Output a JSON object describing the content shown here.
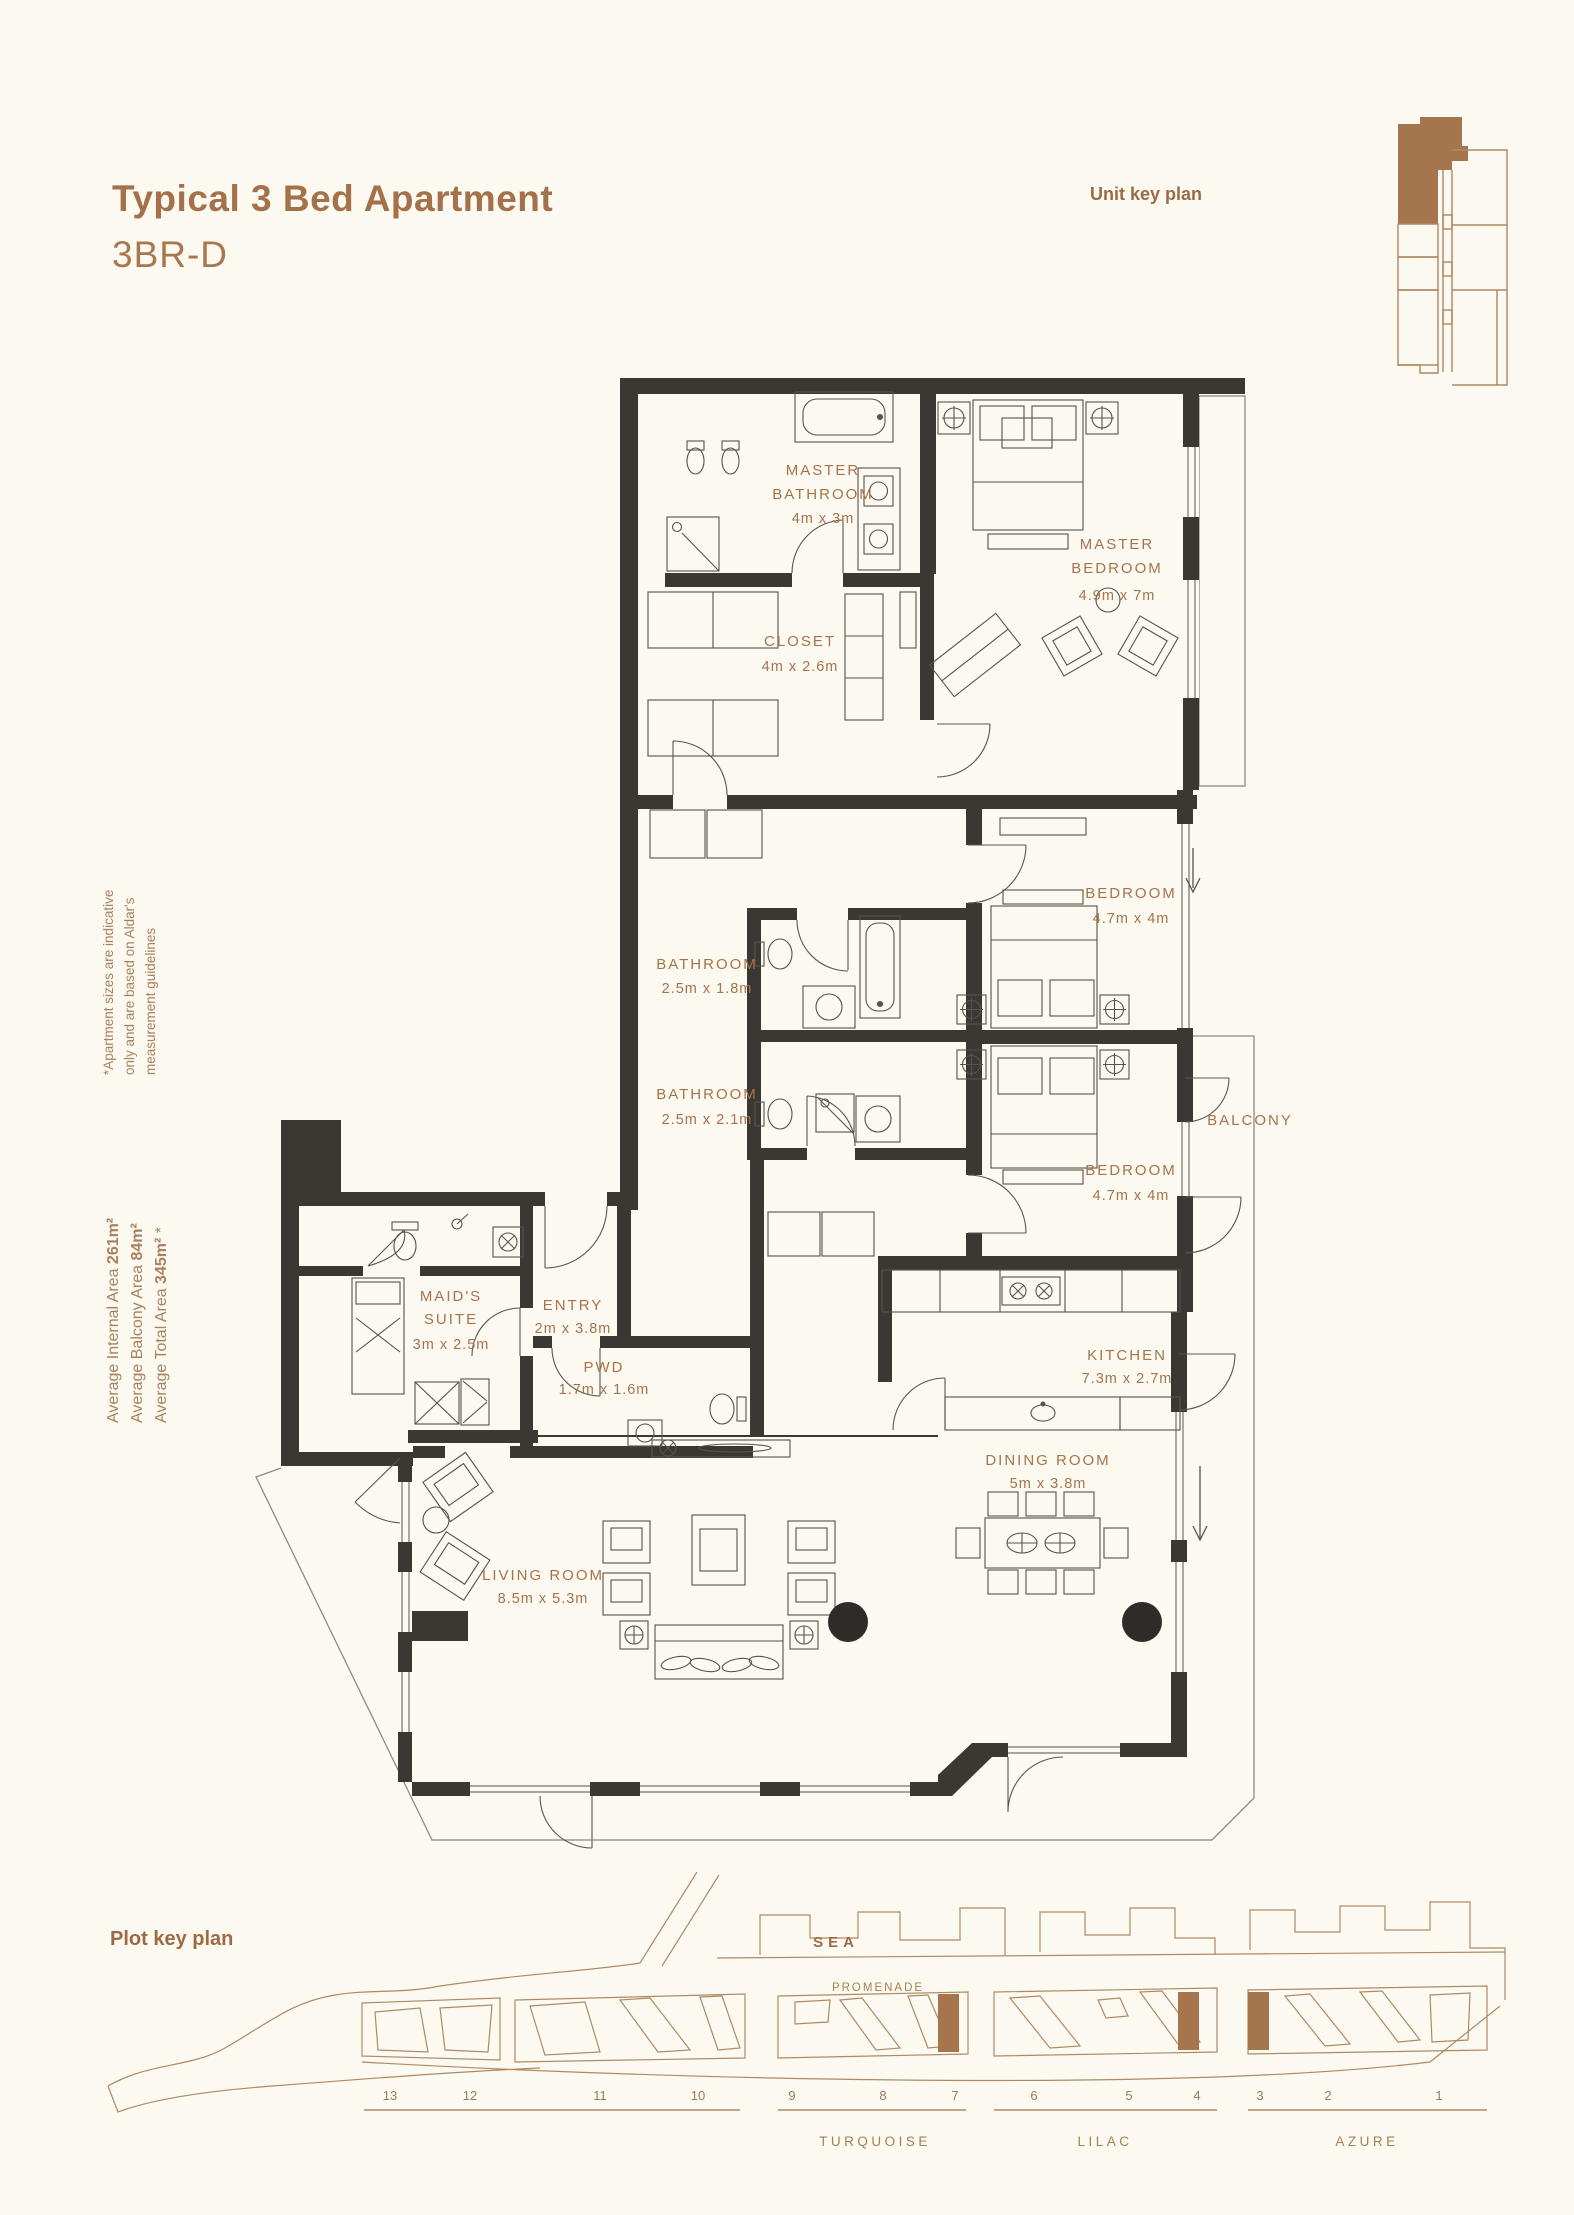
{
  "page": {
    "background": "#FCF9F1",
    "accent": "#A5714A",
    "title": "Typical 3 Bed Apartment",
    "subtitle": "3BR-D",
    "unit_key_plan_label": "Unit key plan",
    "plot_key_plan_label": "Plot key plan",
    "disclaimer_lines": [
      "*Apartment sizes are indicative",
      "only and are based on Aldar's",
      "measurement guidelines"
    ],
    "areas": [
      {
        "label": "Average Internal Area ",
        "value": "261m²",
        "suffix": ""
      },
      {
        "label": "Average Balcony Area ",
        "value": "84m²",
        "suffix": ""
      },
      {
        "label": "Average Total Area ",
        "value": "345m²",
        "suffix": " *"
      }
    ]
  },
  "floorplan": {
    "wall_color": "#3B3733",
    "furniture_line_color": "#56524C",
    "label_color": "#A5744C",
    "rooms": [
      {
        "lines": [
          "MASTER",
          "BATHROOM"
        ],
        "dims": "4m x 3m"
      },
      {
        "lines": [
          "MASTER",
          "BEDROOM"
        ],
        "dims": "4.9m x 7m"
      },
      {
        "lines": [
          "CLOSET"
        ],
        "dims": "4m x 2.6m"
      },
      {
        "lines": [
          "BATHROOM"
        ],
        "dims": "2.5m x 1.8m"
      },
      {
        "lines": [
          "BEDROOM"
        ],
        "dims": "4.7m x 4m"
      },
      {
        "lines": [
          "BATHROOM"
        ],
        "dims": "2.5m x 2.1m"
      },
      {
        "lines": [
          "BALCONY"
        ],
        "dims": ""
      },
      {
        "lines": [
          "BEDROOM"
        ],
        "dims": "4.7m x 4m"
      },
      {
        "lines": [
          "MAID'S",
          "SUITE"
        ],
        "dims": "3m x 2.5m"
      },
      {
        "lines": [
          "ENTRY"
        ],
        "dims": "2m x 3.8m"
      },
      {
        "lines": [
          "PWD"
        ],
        "dims": "1.7m x 1.6m"
      },
      {
        "lines": [
          "KITCHEN"
        ],
        "dims": "7.3m x 2.7m"
      },
      {
        "lines": [
          "DINING ROOM"
        ],
        "dims": "5m x 3.8m"
      },
      {
        "lines": [
          "LIVING ROOM"
        ],
        "dims": "8.5m x 5.3m"
      }
    ]
  },
  "plot_plan": {
    "sea_label": "SEA",
    "promenade_label": "PROMENADE",
    "plot_numbers": [
      "13",
      "12",
      "11",
      "10",
      "9",
      "8",
      "7",
      "6",
      "5",
      "4",
      "3",
      "2",
      "1"
    ],
    "district_labels": [
      "TURQUOISE",
      "LILAC",
      "AZURE"
    ],
    "map_line_color": "#AE8A63",
    "highlight_color": "#A5764E"
  }
}
